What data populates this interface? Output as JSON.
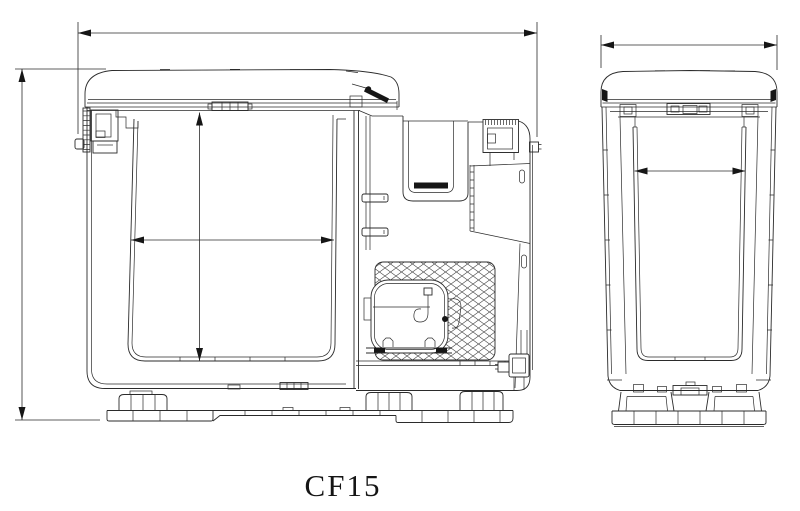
{
  "drawing": {
    "title": "CF15",
    "line_color": "#2b2b2b",
    "accent_fill": "#161616",
    "background_color": "#ffffff",
    "views": [
      {
        "name": "side-section-view"
      },
      {
        "name": "end-view"
      }
    ],
    "dimensions": [
      {
        "name": "overall-length"
      },
      {
        "name": "overall-height"
      },
      {
        "name": "inner-height"
      },
      {
        "name": "inner-length"
      },
      {
        "name": "end-overall-width"
      },
      {
        "name": "end-inner-width"
      }
    ]
  }
}
